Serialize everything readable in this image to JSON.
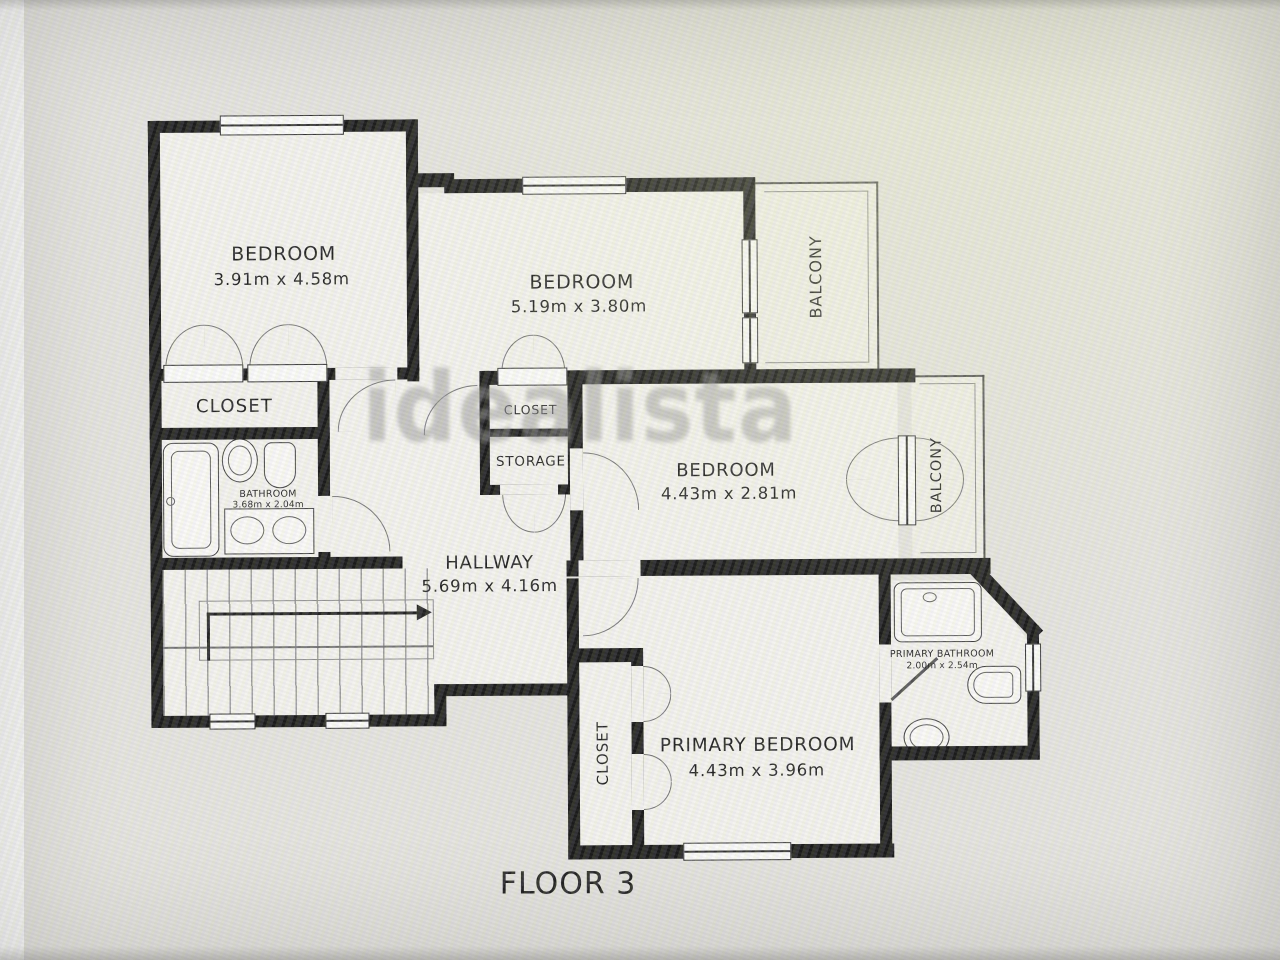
{
  "watermark": "idealista",
  "floor_label": "FLOOR 3",
  "rooms": {
    "bedroom1": {
      "name": "BEDROOM",
      "dims": "3.91m x 4.58m"
    },
    "bedroom2": {
      "name": "BEDROOM",
      "dims": "5.19m x 3.80m"
    },
    "bedroom3": {
      "name": "BEDROOM",
      "dims": "4.43m x 2.81m"
    },
    "primary_bedroom": {
      "name": "PRIMARY BEDROOM",
      "dims": "4.43m x 3.96m"
    },
    "hallway": {
      "name": "HALLWAY",
      "dims": "5.69m x 4.16m"
    },
    "bathroom": {
      "name": "BATHROOM",
      "dims": "3.68m x 2.04m"
    },
    "primary_bathroom": {
      "name": "PRIMARY BATHROOM",
      "dims": "2.00m x 2.54m"
    },
    "closet_bedroom1": {
      "name": "CLOSET"
    },
    "closet_hall": {
      "name": "CLOSET"
    },
    "storage": {
      "name": "STORAGE"
    },
    "closet_primary": {
      "name": "CLOSET"
    },
    "balcony_top": {
      "name": "BALCONY"
    },
    "balcony_mid": {
      "name": "BALCONY"
    }
  },
  "colors": {
    "wall": "#161616",
    "floor": "#f3f2ee",
    "background": "#e4e3df",
    "watermark": "#8e8e8e"
  }
}
